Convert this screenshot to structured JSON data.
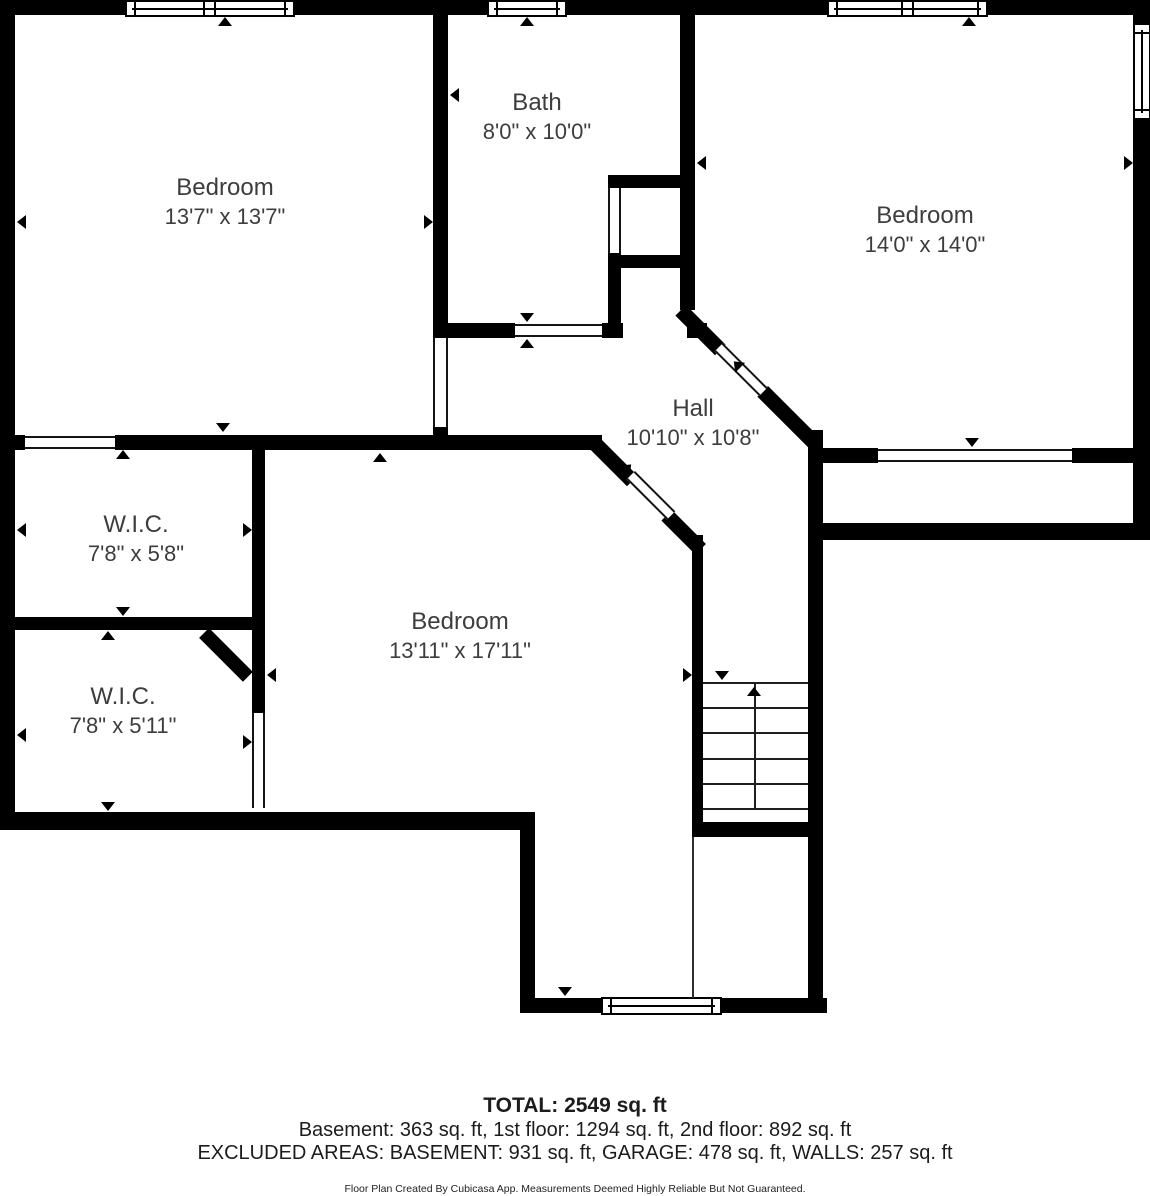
{
  "page": {
    "background": "#ffffff",
    "wall_color": "#000000",
    "label_color": "#3d3d3d"
  },
  "rooms": [
    {
      "name": "Bedroom",
      "dims": "13'7\" x 13'7\"",
      "cx": 225,
      "cy": 202
    },
    {
      "name": "Bath",
      "dims": "8'0\" x 10'0\"",
      "cx": 537,
      "cy": 117
    },
    {
      "name": "Bedroom",
      "dims": "14'0\" x 14'0\"",
      "cx": 925,
      "cy": 230
    },
    {
      "name": "Hall",
      "dims": "10'10\" x 10'8\"",
      "cx": 693,
      "cy": 423
    },
    {
      "name": "W.I.C.",
      "dims": "7'8\" x 5'8\"",
      "cx": 136,
      "cy": 539
    },
    {
      "name": "W.I.C.",
      "dims": "7'8\" x 5'11\"",
      "cx": 123,
      "cy": 711
    },
    {
      "name": "Bedroom",
      "dims": "13'11\" x 17'11\"",
      "cx": 460,
      "cy": 636
    }
  ],
  "footer": {
    "total": "TOTAL: 2549 sq. ft",
    "floors": "Basement: 363 sq. ft, 1st floor: 1294 sq. ft, 2nd floor: 892 sq. ft",
    "excluded": "EXCLUDED AREAS: BASEMENT: 931 sq. ft, GARAGE: 478 sq. ft, WALLS: 257 sq. ft",
    "disclaimer": "Floor Plan Created By Cubicasa App. Measurements Deemed Highly Reliable But Not Guaranteed."
  },
  "plan": {
    "walls": [
      [
        0,
        0,
        1150,
        15
      ],
      [
        0,
        0,
        15,
        830
      ],
      [
        1133,
        0,
        17,
        540
      ],
      [
        433,
        15,
        15,
        323
      ],
      [
        433,
        427,
        15,
        23
      ],
      [
        680,
        15,
        15,
        295
      ],
      [
        608,
        175,
        87,
        13
      ],
      [
        608,
        253,
        13,
        70
      ],
      [
        608,
        255,
        87,
        13
      ],
      [
        433,
        323,
        82,
        15
      ],
      [
        602,
        323,
        21,
        15
      ],
      [
        687,
        323,
        20,
        15
      ],
      [
        15,
        435,
        10,
        15
      ],
      [
        115,
        435,
        487,
        15
      ],
      [
        823,
        448,
        55,
        15
      ],
      [
        1072,
        448,
        61,
        15
      ],
      [
        823,
        523,
        327,
        17
      ],
      [
        808,
        430,
        15,
        583
      ],
      [
        15,
        617,
        250,
        13
      ],
      [
        252,
        448,
        13,
        265
      ],
      [
        0,
        812,
        535,
        18
      ],
      [
        520,
        830,
        15,
        183
      ],
      [
        520,
        998,
        307,
        15
      ],
      [
        692,
        535,
        11,
        288
      ],
      [
        692,
        822,
        131,
        15
      ]
    ],
    "diagonals": [
      [
        598,
        436,
        56,
        15
      ],
      [
        672,
        510,
        48,
        15
      ],
      [
        686,
        305,
        56,
        15
      ],
      [
        768,
        386,
        78,
        15
      ],
      [
        209,
        628,
        62,
        14
      ]
    ],
    "doors": [
      [
        433,
        338,
        15,
        89,
        "v"
      ],
      [
        25,
        436,
        90,
        13,
        "h"
      ],
      [
        515,
        324,
        87,
        13,
        "h"
      ],
      [
        608,
        188,
        13,
        65,
        "v"
      ],
      [
        252,
        713,
        13,
        95,
        "v"
      ],
      [
        878,
        449,
        194,
        13,
        "h"
      ]
    ],
    "diagonal_doors": [
      [
        635,
        471,
        57,
        12
      ],
      [
        723,
        343,
        63,
        12
      ]
    ],
    "windows": [
      {
        "x": 125,
        "y": 0,
        "w": 170,
        "h": 17,
        "o": "h",
        "double": true
      },
      {
        "x": 487,
        "y": 0,
        "w": 80,
        "h": 17,
        "o": "h",
        "double": false
      },
      {
        "x": 827,
        "y": 0,
        "w": 161,
        "h": 17,
        "o": "h",
        "double": true
      },
      {
        "x": 1133,
        "y": 23,
        "w": 18,
        "h": 97,
        "o": "v",
        "double": false
      },
      {
        "x": 601,
        "y": 997,
        "w": 121,
        "h": 18,
        "o": "h",
        "double": false
      }
    ],
    "markers": [
      {
        "l": 218,
        "t": 17,
        "d": "up"
      },
      {
        "l": 520,
        "t": 17,
        "d": "up"
      },
      {
        "l": 962,
        "t": 17,
        "d": "up"
      },
      {
        "l": 17,
        "t": 215,
        "d": "left"
      },
      {
        "l": 424,
        "t": 215,
        "d": "right"
      },
      {
        "l": 450,
        "t": 88,
        "d": "left"
      },
      {
        "l": 520,
        "t": 313,
        "d": "down"
      },
      {
        "l": 520,
        "t": 339,
        "d": "up"
      },
      {
        "l": 697,
        "t": 156,
        "d": "left"
      },
      {
        "l": 1124,
        "t": 156,
        "d": "right"
      },
      {
        "l": 965,
        "t": 438,
        "d": "down"
      },
      {
        "l": 116,
        "t": 450,
        "d": "up"
      },
      {
        "l": 116,
        "t": 607,
        "d": "down"
      },
      {
        "l": 17,
        "t": 523,
        "d": "left"
      },
      {
        "l": 243,
        "t": 523,
        "d": "right"
      },
      {
        "l": 101,
        "t": 631,
        "d": "up"
      },
      {
        "l": 101,
        "t": 802,
        "d": "down"
      },
      {
        "l": 17,
        "t": 728,
        "d": "left"
      },
      {
        "l": 243,
        "t": 735,
        "d": "right"
      },
      {
        "l": 267,
        "t": 668,
        "d": "left"
      },
      {
        "l": 683,
        "t": 668,
        "d": "right"
      },
      {
        "l": 373,
        "t": 453,
        "d": "up"
      },
      {
        "l": 216,
        "t": 423,
        "d": "down"
      },
      {
        "l": 621,
        "t": 463,
        "d": "up",
        "r": 45
      },
      {
        "l": 730,
        "t": 360,
        "d": "up",
        "r": -45
      },
      {
        "l": 715,
        "t": 671,
        "d": "down"
      },
      {
        "l": 558,
        "t": 987,
        "d": "down"
      }
    ],
    "stairs": {
      "x": 703,
      "w": 105,
      "treads": [
        682,
        707,
        732,
        758,
        783,
        808
      ],
      "rail_x": 754,
      "rail_y1": 682,
      "rail_y2": 808,
      "arrow_l": 747,
      "arrow_t": 687
    },
    "thin_lines": [
      [
        692,
        837,
        2,
        161
      ]
    ]
  }
}
